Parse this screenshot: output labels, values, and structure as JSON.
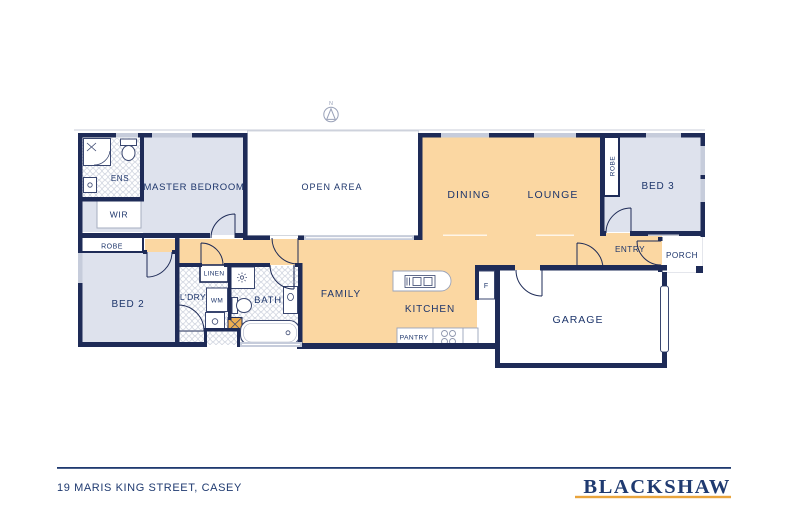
{
  "title": "Floor plan",
  "compass": {
    "label": "N"
  },
  "rooms": {
    "ens": {
      "label": "ENS"
    },
    "master": {
      "label": "MASTER BEDROOM"
    },
    "wir": {
      "label": "WIR"
    },
    "robe2": {
      "label": "ROBE"
    },
    "bed2": {
      "label": "BED 2"
    },
    "ldry": {
      "label": "L'DRY"
    },
    "linen": {
      "label": "LINEN"
    },
    "wm": {
      "label": "WM"
    },
    "bath": {
      "label": "BATH"
    },
    "open_area": {
      "label": "OPEN AREA"
    },
    "family": {
      "label": "FAMILY"
    },
    "kitchen": {
      "label": "KITCHEN"
    },
    "pantry": {
      "label": "PANTRY"
    },
    "fridge": {
      "label": "F"
    },
    "dining": {
      "label": "DINING"
    },
    "lounge": {
      "label": "LOUNGE"
    },
    "robe3": {
      "label": "ROBE"
    },
    "bed3": {
      "label": "BED 3"
    },
    "entry": {
      "label": "ENTRY"
    },
    "porch": {
      "label": "PORCH"
    },
    "garage": {
      "label": "GARAGE"
    }
  },
  "footer": {
    "address": "19 MARIS KING STREET, CASEY",
    "brand": "BLACKSHAW"
  },
  "colors": {
    "wall": "#1e2b57",
    "living": "#fbd7a2",
    "bedroom": "#dee2ed",
    "window": "#c6ccdb",
    "eave": "#c9cdd8",
    "label": "#1d356b",
    "brand": "#1f3a70",
    "gold": "#e9a43c",
    "xbox": "#efae51",
    "compass": "#99a1b8"
  }
}
